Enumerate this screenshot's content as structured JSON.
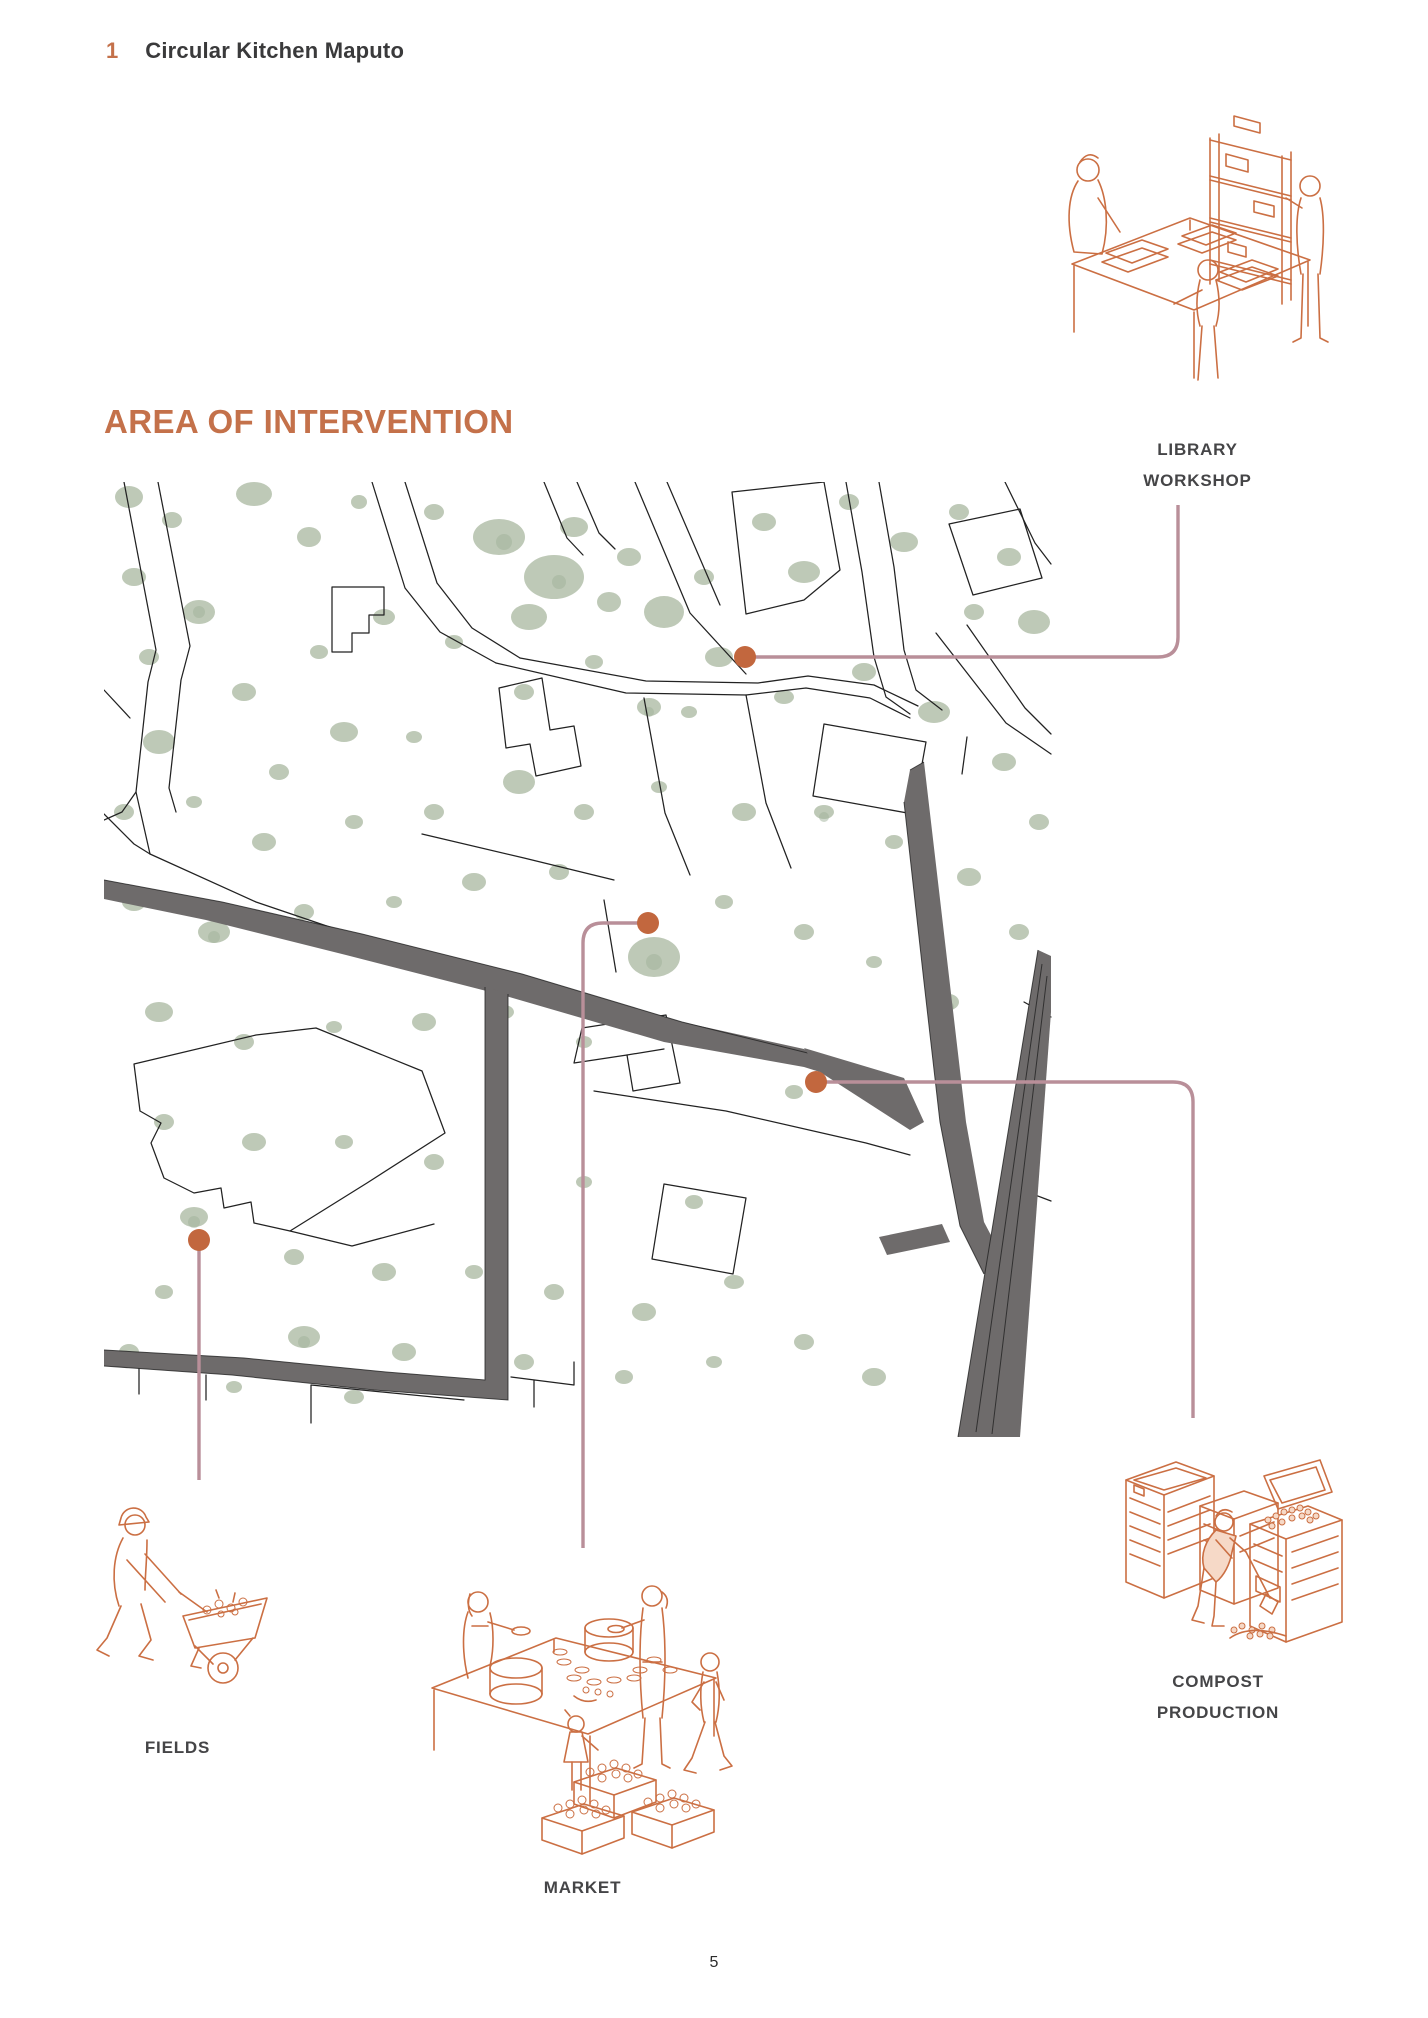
{
  "header": {
    "chapter_number": "1",
    "title": "Circular Kitchen Maputo"
  },
  "section": {
    "title": "AREA OF INTERVENTION"
  },
  "callouts": {
    "library_workshop": {
      "line1": "LIBRARY",
      "line2": "WORKSHOP"
    },
    "fields": {
      "label": "FIELDS"
    },
    "market": {
      "label": "MARKET"
    },
    "compost_production": {
      "line1": "COMPOST",
      "line2": "PRODUCTION"
    }
  },
  "icons": {
    "library_workshop": "library-workshop-isometric-illustration",
    "fields": "farmer-wheelbarrow-illustration",
    "market": "market-stall-illustration",
    "compost_production": "compost-bins-illustration"
  },
  "footer": {
    "page_number": "5"
  },
  "colors": {
    "accent": "#c4714a",
    "ink": "#222222",
    "rose": "#b98f99",
    "dot": "#c2673e",
    "road": "#6e6b6b",
    "green": "#b7c3af",
    "green_dark": "#9fb29a",
    "ill": "#cb6f43",
    "ill_light": "#f6d9c7",
    "title": "#3a3a3b",
    "label": "#454547"
  }
}
